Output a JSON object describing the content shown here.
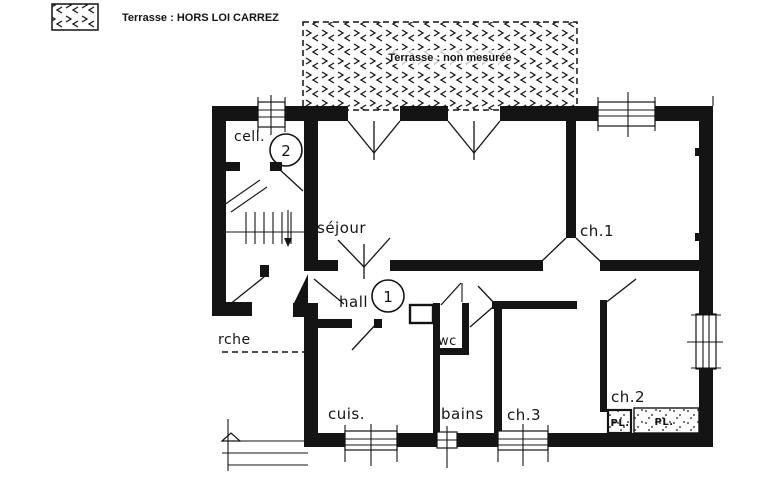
{
  "colors": {
    "ink": "#141414",
    "paper": "#ffffff"
  },
  "legend": {
    "label": "Terrasse : HORS LOI CARREZ"
  },
  "terrace": {
    "label": "Terrasse : non mesurée"
  },
  "markers": {
    "hall_number": "1",
    "cell_number": "2"
  },
  "rooms": {
    "cell": "cell.",
    "sejour": "séjour",
    "ch1": "ch.1",
    "hall": "hall",
    "wc": "wc",
    "cuis": "cuis.",
    "bains": "bains",
    "ch3": "ch.3",
    "ch2": "ch.2",
    "pl_small": "PL.",
    "pl_large": "PL.",
    "porch": "rche"
  }
}
